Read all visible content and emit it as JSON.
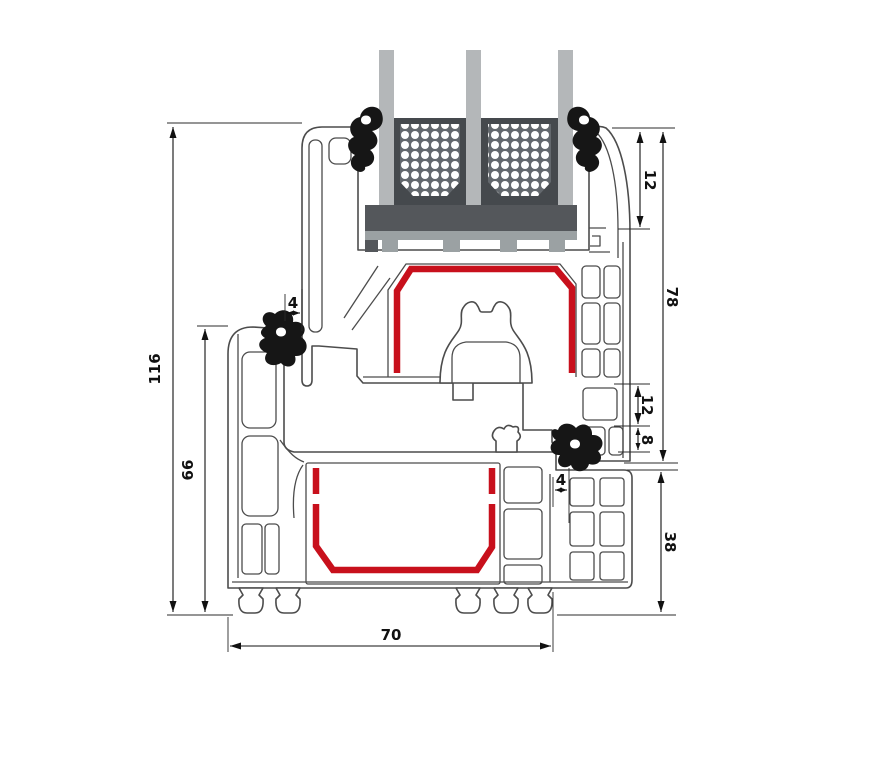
{
  "diagram": {
    "name": "window-frame-profile-cross-section",
    "dims": {
      "overall_height": "116",
      "frame_height": "66",
      "gap_left": "4",
      "bead_height": "12",
      "sash_height": "78",
      "groove_offset": "12",
      "groove_depth": "8",
      "gap_right": "4",
      "frame_face_height": "38",
      "profile_depth": "70"
    },
    "colors": {
      "steel_reinforcement": "#c8101c",
      "gasket": "#161616",
      "glass": "#b4b7b9",
      "spacer_box": "#45494d",
      "spacer_panel": "#63686d",
      "setting_block": "#54575b",
      "glazing_bridge": "#9ba1a3",
      "profile_outline": "#4c4c4c",
      "dimension": "#111111"
    }
  }
}
